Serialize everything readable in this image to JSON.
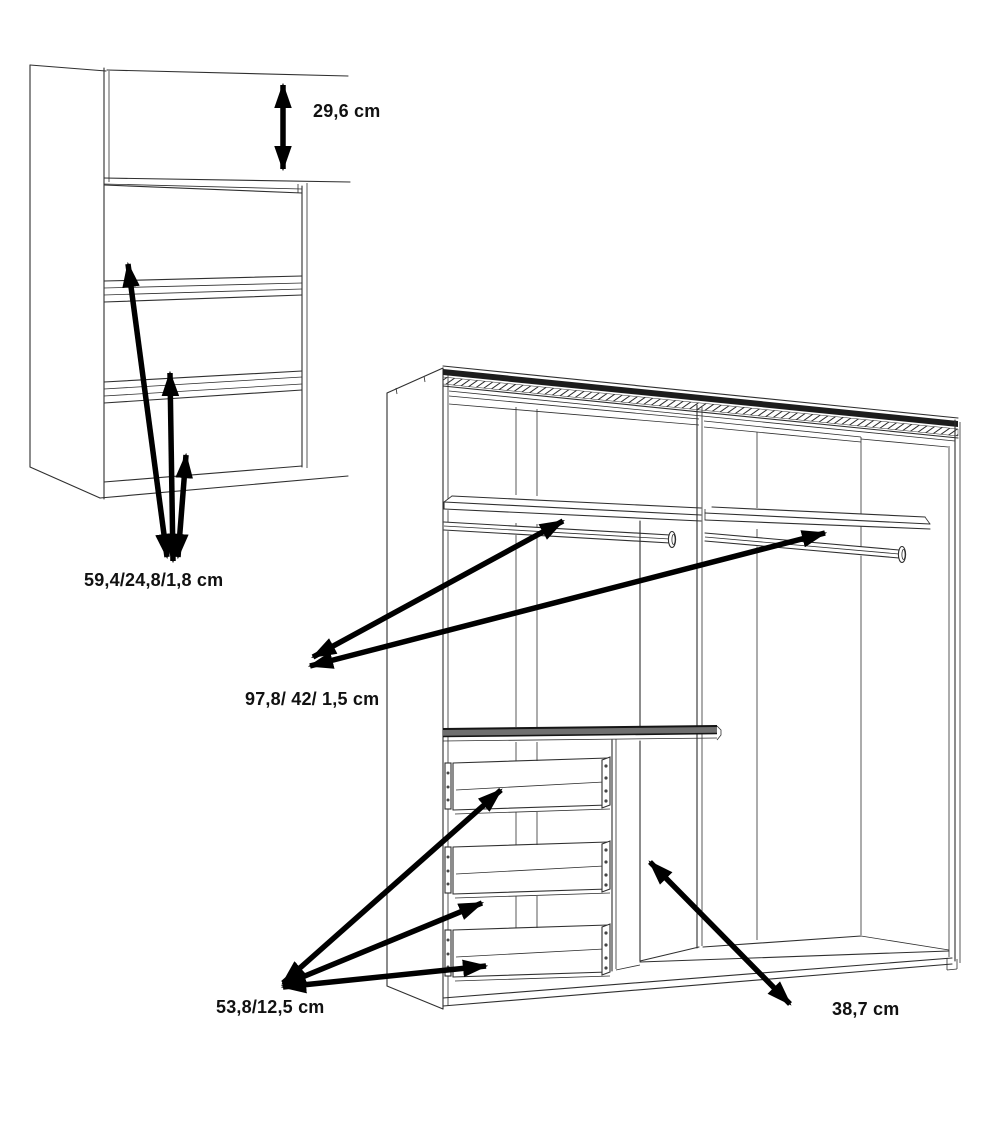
{
  "title": "Wardrobe interior dimension diagram",
  "colors": {
    "background": "#ffffff",
    "line": "#2f2f2f",
    "arrow": "#000000",
    "text": "#111111"
  },
  "labels": {
    "shelf_height": "29,6 cm",
    "drawer_front_dims": "59,4/24,8/1,8 cm",
    "shelf_dims": "97,8/ 42/ 1,5 cm",
    "drawer_inner_dims": "53,8/12,5 cm",
    "side_section_depth": "38,7 cm"
  }
}
